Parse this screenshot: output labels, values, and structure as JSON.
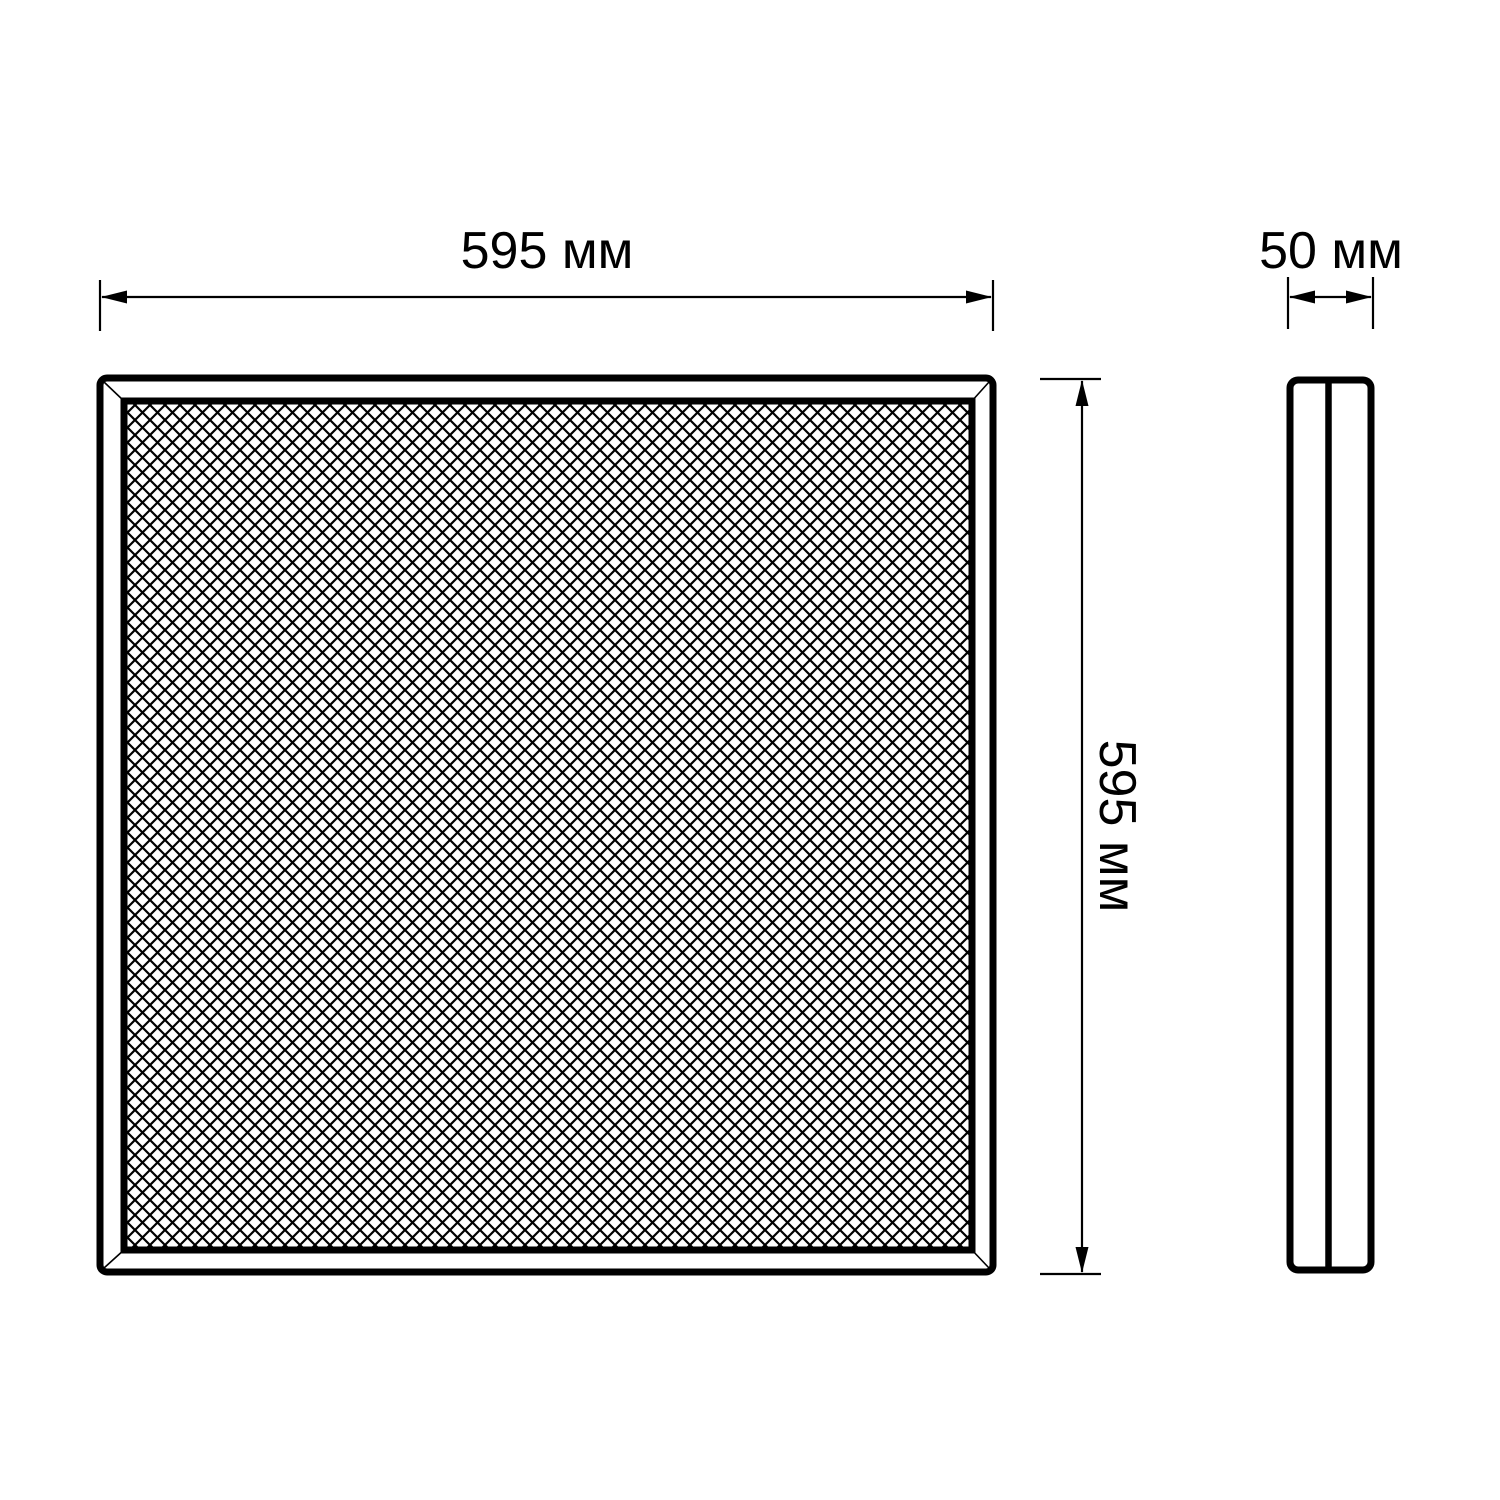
{
  "drawing": {
    "front_view": {
      "width_dimension": {
        "label": "595 мм",
        "value": 595,
        "unit": "мм"
      },
      "height_dimension": {
        "label": "595 мм",
        "value": 595,
        "unit": "мм"
      }
    },
    "side_view": {
      "depth_dimension": {
        "label": "50 мм",
        "value": 50,
        "unit": "мм"
      }
    },
    "colors": {
      "line": "#000000",
      "background": "#ffffff"
    }
  }
}
